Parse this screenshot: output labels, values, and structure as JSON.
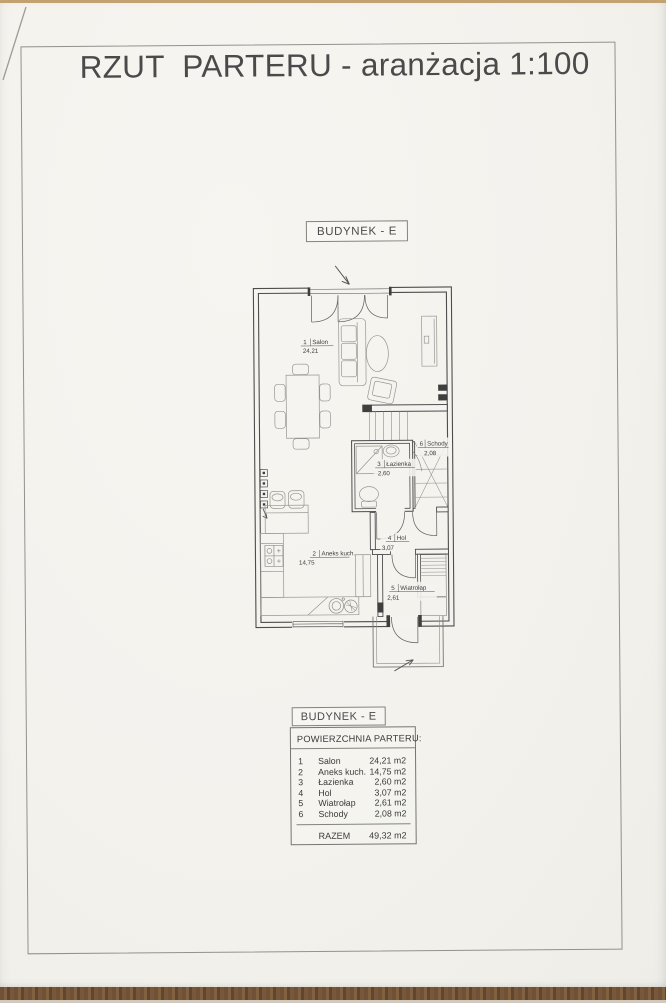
{
  "page": {
    "title": "RZUT  PARTERU - aranżacja 1:100"
  },
  "building_label": "BUDYNEK - E",
  "plan": {
    "rooms": [
      {
        "no": "1",
        "name": "Salon",
        "area": "24,21"
      },
      {
        "no": "2",
        "name": "Aneks kuch.",
        "area": "14,75"
      },
      {
        "no": "3",
        "name": "Łazienka",
        "area": "2,60"
      },
      {
        "no": "4",
        "name": "Hol",
        "area": "3,07"
      },
      {
        "no": "5",
        "name": "Wiatrołap",
        "area": "2,61"
      },
      {
        "no": "6",
        "name": "Schody",
        "area": "2,08"
      }
    ]
  },
  "legend": {
    "building": "BUDYNEK - E",
    "header": "POWIERZCHNIA PARTERU:",
    "rows": [
      {
        "no": "1",
        "name": "Salon",
        "area": "24,21 m2"
      },
      {
        "no": "2",
        "name": "Aneks kuch.",
        "area": "14,75 m2"
      },
      {
        "no": "3",
        "name": "Łazienka",
        "area": "2,60 m2"
      },
      {
        "no": "4",
        "name": "Hol",
        "area": "3,07 m2"
      },
      {
        "no": "5",
        "name": "Wiatrołap",
        "area": "2,61 m2"
      },
      {
        "no": "6",
        "name": "Schody",
        "area": "2,08 m2"
      }
    ],
    "total_label": "RAZEM",
    "total_area": "49,32 m2"
  },
  "colors": {
    "paper": "#f5f3ef",
    "ink": "#474747",
    "furniture": "#97968f",
    "wood": "#6e5136"
  }
}
